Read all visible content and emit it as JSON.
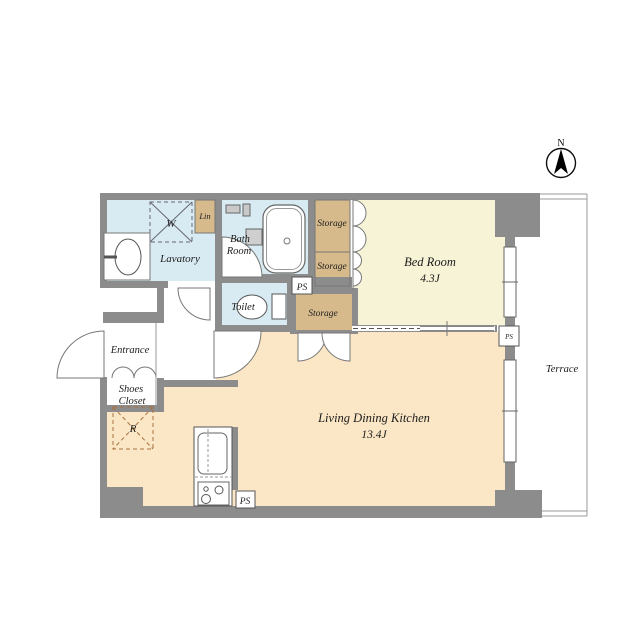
{
  "plan": {
    "rooms": {
      "bed_room": {
        "label": "Bed Room",
        "size": "4.3J"
      },
      "ldk": {
        "label": "Living Dining Kitchen",
        "size": "13.4J"
      },
      "lavatory": {
        "label": "Lavatory"
      },
      "bath_room": {
        "label_line1": "Bath",
        "label_line2": "Room"
      },
      "toilet": {
        "label": "Toilet"
      },
      "entrance": {
        "label": "Entrance"
      },
      "shoes_closet": {
        "label_line1": "Shoes",
        "label_line2": "Closet"
      },
      "lin": {
        "label": "Lin"
      },
      "storage_bed_upper": {
        "label": "Storage"
      },
      "storage_bed_lower": {
        "label": "Storage"
      },
      "storage_ldk": {
        "label": "Storage"
      },
      "terrace": {
        "label": "Terrace"
      }
    },
    "fixtures": {
      "washing_machine": {
        "label": "W"
      },
      "refrigerator": {
        "label": "R"
      },
      "pipe_shaft_top": {
        "label": "PS"
      },
      "pipe_shaft_kitchen": {
        "label": "PS"
      },
      "pipe_shaft_east": {
        "label": "PS"
      }
    },
    "compass": {
      "label": "N"
    },
    "colors": {
      "wall": "#8c8c8c",
      "bed_room": "#f7f3d6",
      "ldk": "#fbe7c5",
      "wet_area": "#d8ebf2",
      "storage": "#d7ba8c",
      "background": "#ffffff"
    }
  }
}
